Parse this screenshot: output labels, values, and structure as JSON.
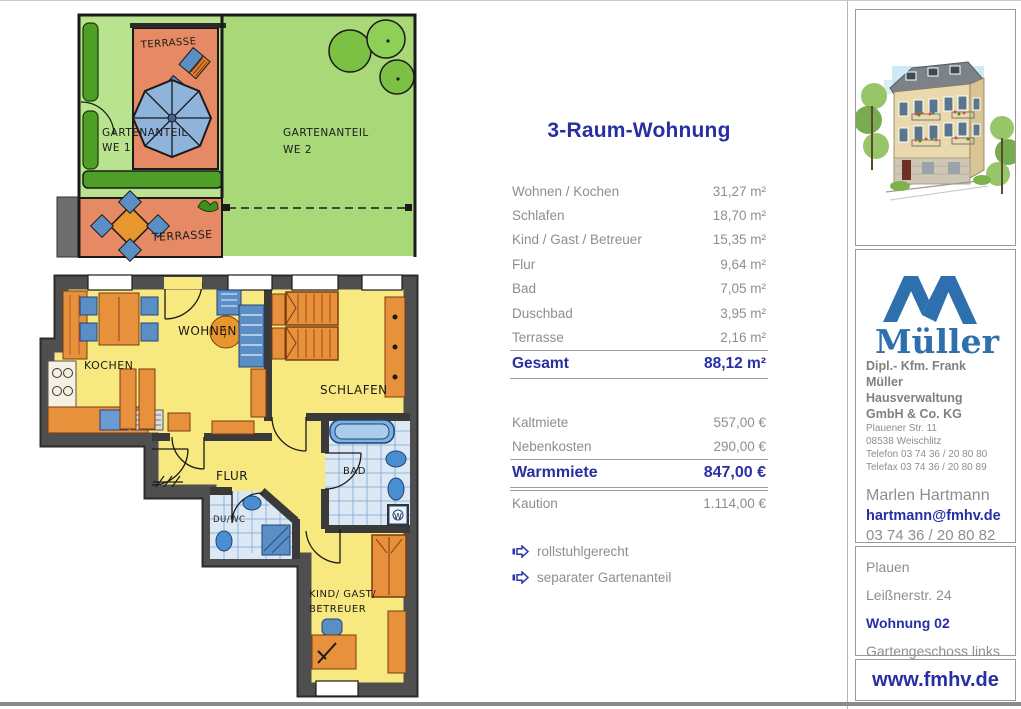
{
  "details": {
    "title": "3-Raum-Wohnung",
    "rooms": [
      {
        "label": "Wohnen / Kochen",
        "value": "31,27 m²"
      },
      {
        "label": "Schlafen",
        "value": "18,70 m²"
      },
      {
        "label": "Kind / Gast / Betreuer",
        "value": "15,35 m²"
      },
      {
        "label": "Flur",
        "value": "9,64 m²"
      },
      {
        "label": "Bad",
        "value": "7,05 m²"
      },
      {
        "label": "Duschbad",
        "value": "3,95 m²"
      },
      {
        "label": "Terrasse",
        "value": "2,16 m²"
      }
    ],
    "total": {
      "label": "Gesamt",
      "value": "88,12 m²"
    },
    "costs": [
      {
        "label": "Kaltmiete",
        "value": "557,00 €"
      },
      {
        "label": "Nebenkosten",
        "value": "290,00 €"
      }
    ],
    "warm": {
      "label": "Warmmiete",
      "value": "847,00 €"
    },
    "deposit": {
      "label": "Kaution",
      "value": "1.114,00 €"
    },
    "features": [
      {
        "label": "rollstuhlgerecht"
      },
      {
        "label": "separater Gartenanteil"
      }
    ]
  },
  "plan": {
    "terrasse_top": "TERRASSE",
    "terrasse_bottom": "TERRASSE",
    "gartenanteil1": "GARTENANTEIL",
    "we1": "WE 1",
    "gartenanteil2": "GARTENANTEIL",
    "we2": "WE 2",
    "kochen": "KOCHEN",
    "wohnen": "WOHNEN",
    "schlafen": "SCHLAFEN",
    "flur": "FLUR",
    "bad": "BAD",
    "duwc": "DU/WC",
    "kind_line1": "KIND/ GAST/",
    "kind_line2": "BETREUER",
    "washer": "W"
  },
  "sidebar": {
    "logo_text": "Müller",
    "company": {
      "line1": "Dipl.- Kfm. Frank Müller",
      "line2": "Hausverwaltung",
      "line3": "GmbH & Co. KG",
      "address1": "Plauener Str. 11",
      "address2": "08538 Weischlitz",
      "phone": "Telefon  03 74 36 / 20 80 80",
      "fax": "Telefax 03 74 36 / 20 80 89"
    },
    "contact": {
      "name": "Marlen Hartmann",
      "email": "hartmann@fmhv.de",
      "phone": "03 74 36 / 20 80 82"
    },
    "location": {
      "city": "Plauen",
      "street": "Leißnerstr. 24",
      "unit": "Wohnung 02",
      "floor": "Gartengeschoss links"
    },
    "website": "www.fmhv.de"
  },
  "colors": {
    "accent_blue": "#272fa3",
    "logo_blue": "#2e6fad",
    "text_gray": "#8e8e8e",
    "plan_yellow": "#f7e97f",
    "plan_green_we1": "#b9e38e",
    "plan_green_we2": "#a8d878",
    "plan_terrace": "#e58a64",
    "plan_furniture": "#e8913c",
    "plan_blue": "#5b8ec4"
  }
}
